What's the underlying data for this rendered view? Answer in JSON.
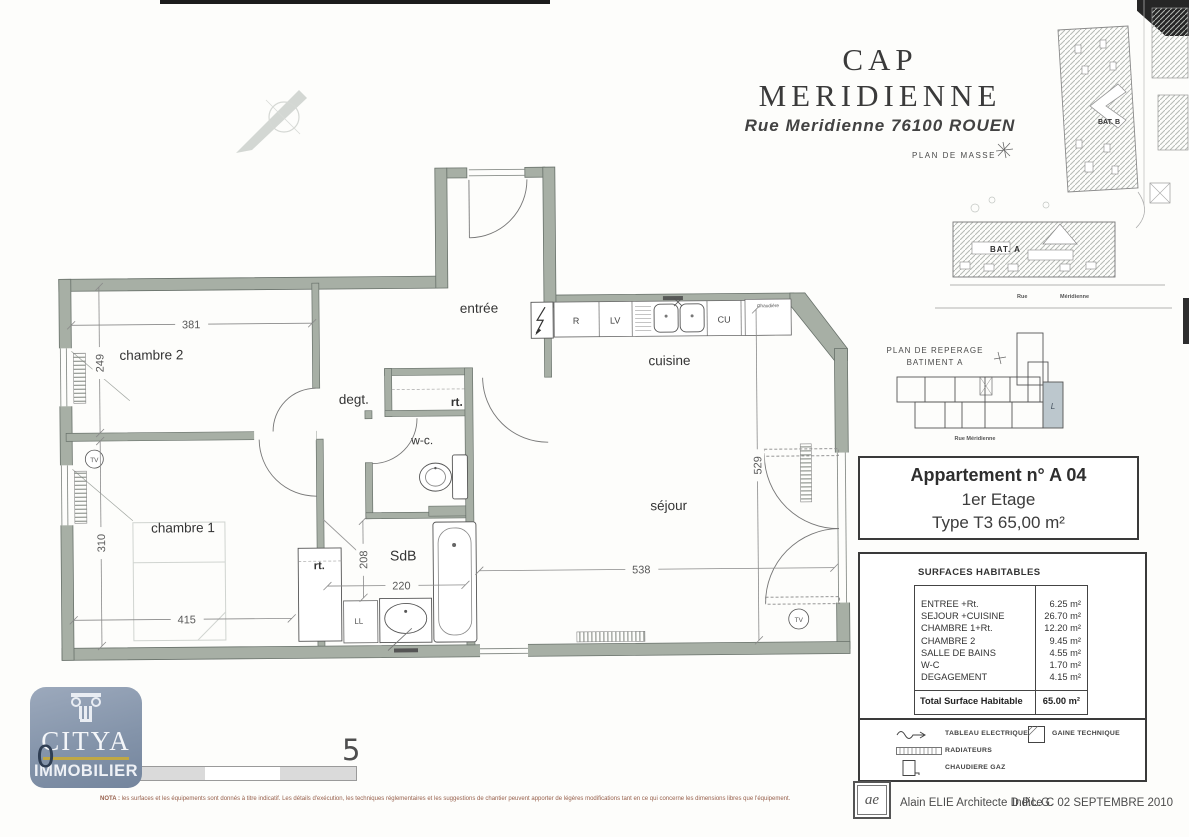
{
  "header": {
    "title": "CAP  MERIDIENNE",
    "subtitle": "Rue Meridienne 76100  ROUEN"
  },
  "site_plan": {
    "label": "PLAN  DE  MASSE",
    "bat_a": "BAT. A",
    "bat_b": "BAT. B",
    "street_word1": "Rue",
    "street_word2": "Méridienne"
  },
  "key_plan": {
    "label_line1": "PLAN  DE  REPERAGE",
    "label_line2": "BATIMENT A",
    "street": "Rue  Méridienne",
    "unit_mark": "L"
  },
  "apartment_box": {
    "line1": "Appartement n° A 04",
    "line2": "1er Etage",
    "line3": "Type  T3  65,00 m²"
  },
  "surfaces": {
    "title": "SURFACES HABITABLES",
    "rows": [
      {
        "label": "ENTREE +Rt.",
        "value": "6.25 m²"
      },
      {
        "label": "SEJOUR +CUISINE",
        "value": "26.70 m²"
      },
      {
        "label": "CHAMBRE 1+Rt.",
        "value": "12.20 m²"
      },
      {
        "label": "CHAMBRE 2",
        "value": "9.45 m²"
      },
      {
        "label": "SALLE DE BAINS",
        "value": "4.55 m²"
      },
      {
        "label": "W-C",
        "value": "1.70 m²"
      },
      {
        "label": "DEGAGEMENT",
        "value": "4.15 m²"
      }
    ],
    "total_label": "Total Surface  Habitable",
    "total_value": "65.00 m²"
  },
  "legend": {
    "items": [
      {
        "label": "TABLEAU ELECTRIQUE"
      },
      {
        "label": "RADIATEURS"
      },
      {
        "label": "CHAUDIERE GAZ"
      },
      {
        "label": "GAINE TECHNIQUE"
      }
    ]
  },
  "footer": {
    "stamp": "ae",
    "architect": "Alain ELIE  Architecte D.P.L.G.",
    "indice": "Indice C 02 SEPTEMBRE 2010"
  },
  "brand": {
    "name": "CITYA",
    "tagline": "IMMOBILIER"
  },
  "scale_bar": {
    "start": "0",
    "end": "5"
  },
  "nota_prefix": "NOTA :",
  "nota": " les surfaces et les équipements sont donnés à titre indicatif. Les détails d'exécution, les techniques réglementaires et les suggestions de chantier peuvent apporter de légères modifications tant en ce qui concerne les dimensions libres que l'équipement.",
  "floor_plan": {
    "rooms": {
      "entree": "entrée",
      "chambre2": "chambre 2",
      "chambre1": "chambre 1",
      "degagement": "degt.",
      "wc": "w-c.",
      "sdb": "SdB",
      "cuisine": "cuisine",
      "sejour": "séjour",
      "rangement": "rt.",
      "lave_linge": "LL"
    },
    "dimensions": {
      "chambre2_width": "381",
      "chambre2_height": "249",
      "chambre1_height": "310",
      "chambre1_width": "415",
      "sdb_height": "208",
      "sdb_width": "220",
      "sejour_height": "529",
      "sejour_width": "538"
    },
    "appliances": {
      "fridge": "R",
      "dishwasher": "LV",
      "hob": "CU",
      "boiler": "Chaudière"
    },
    "outlets": {
      "tv": "TV"
    }
  }
}
